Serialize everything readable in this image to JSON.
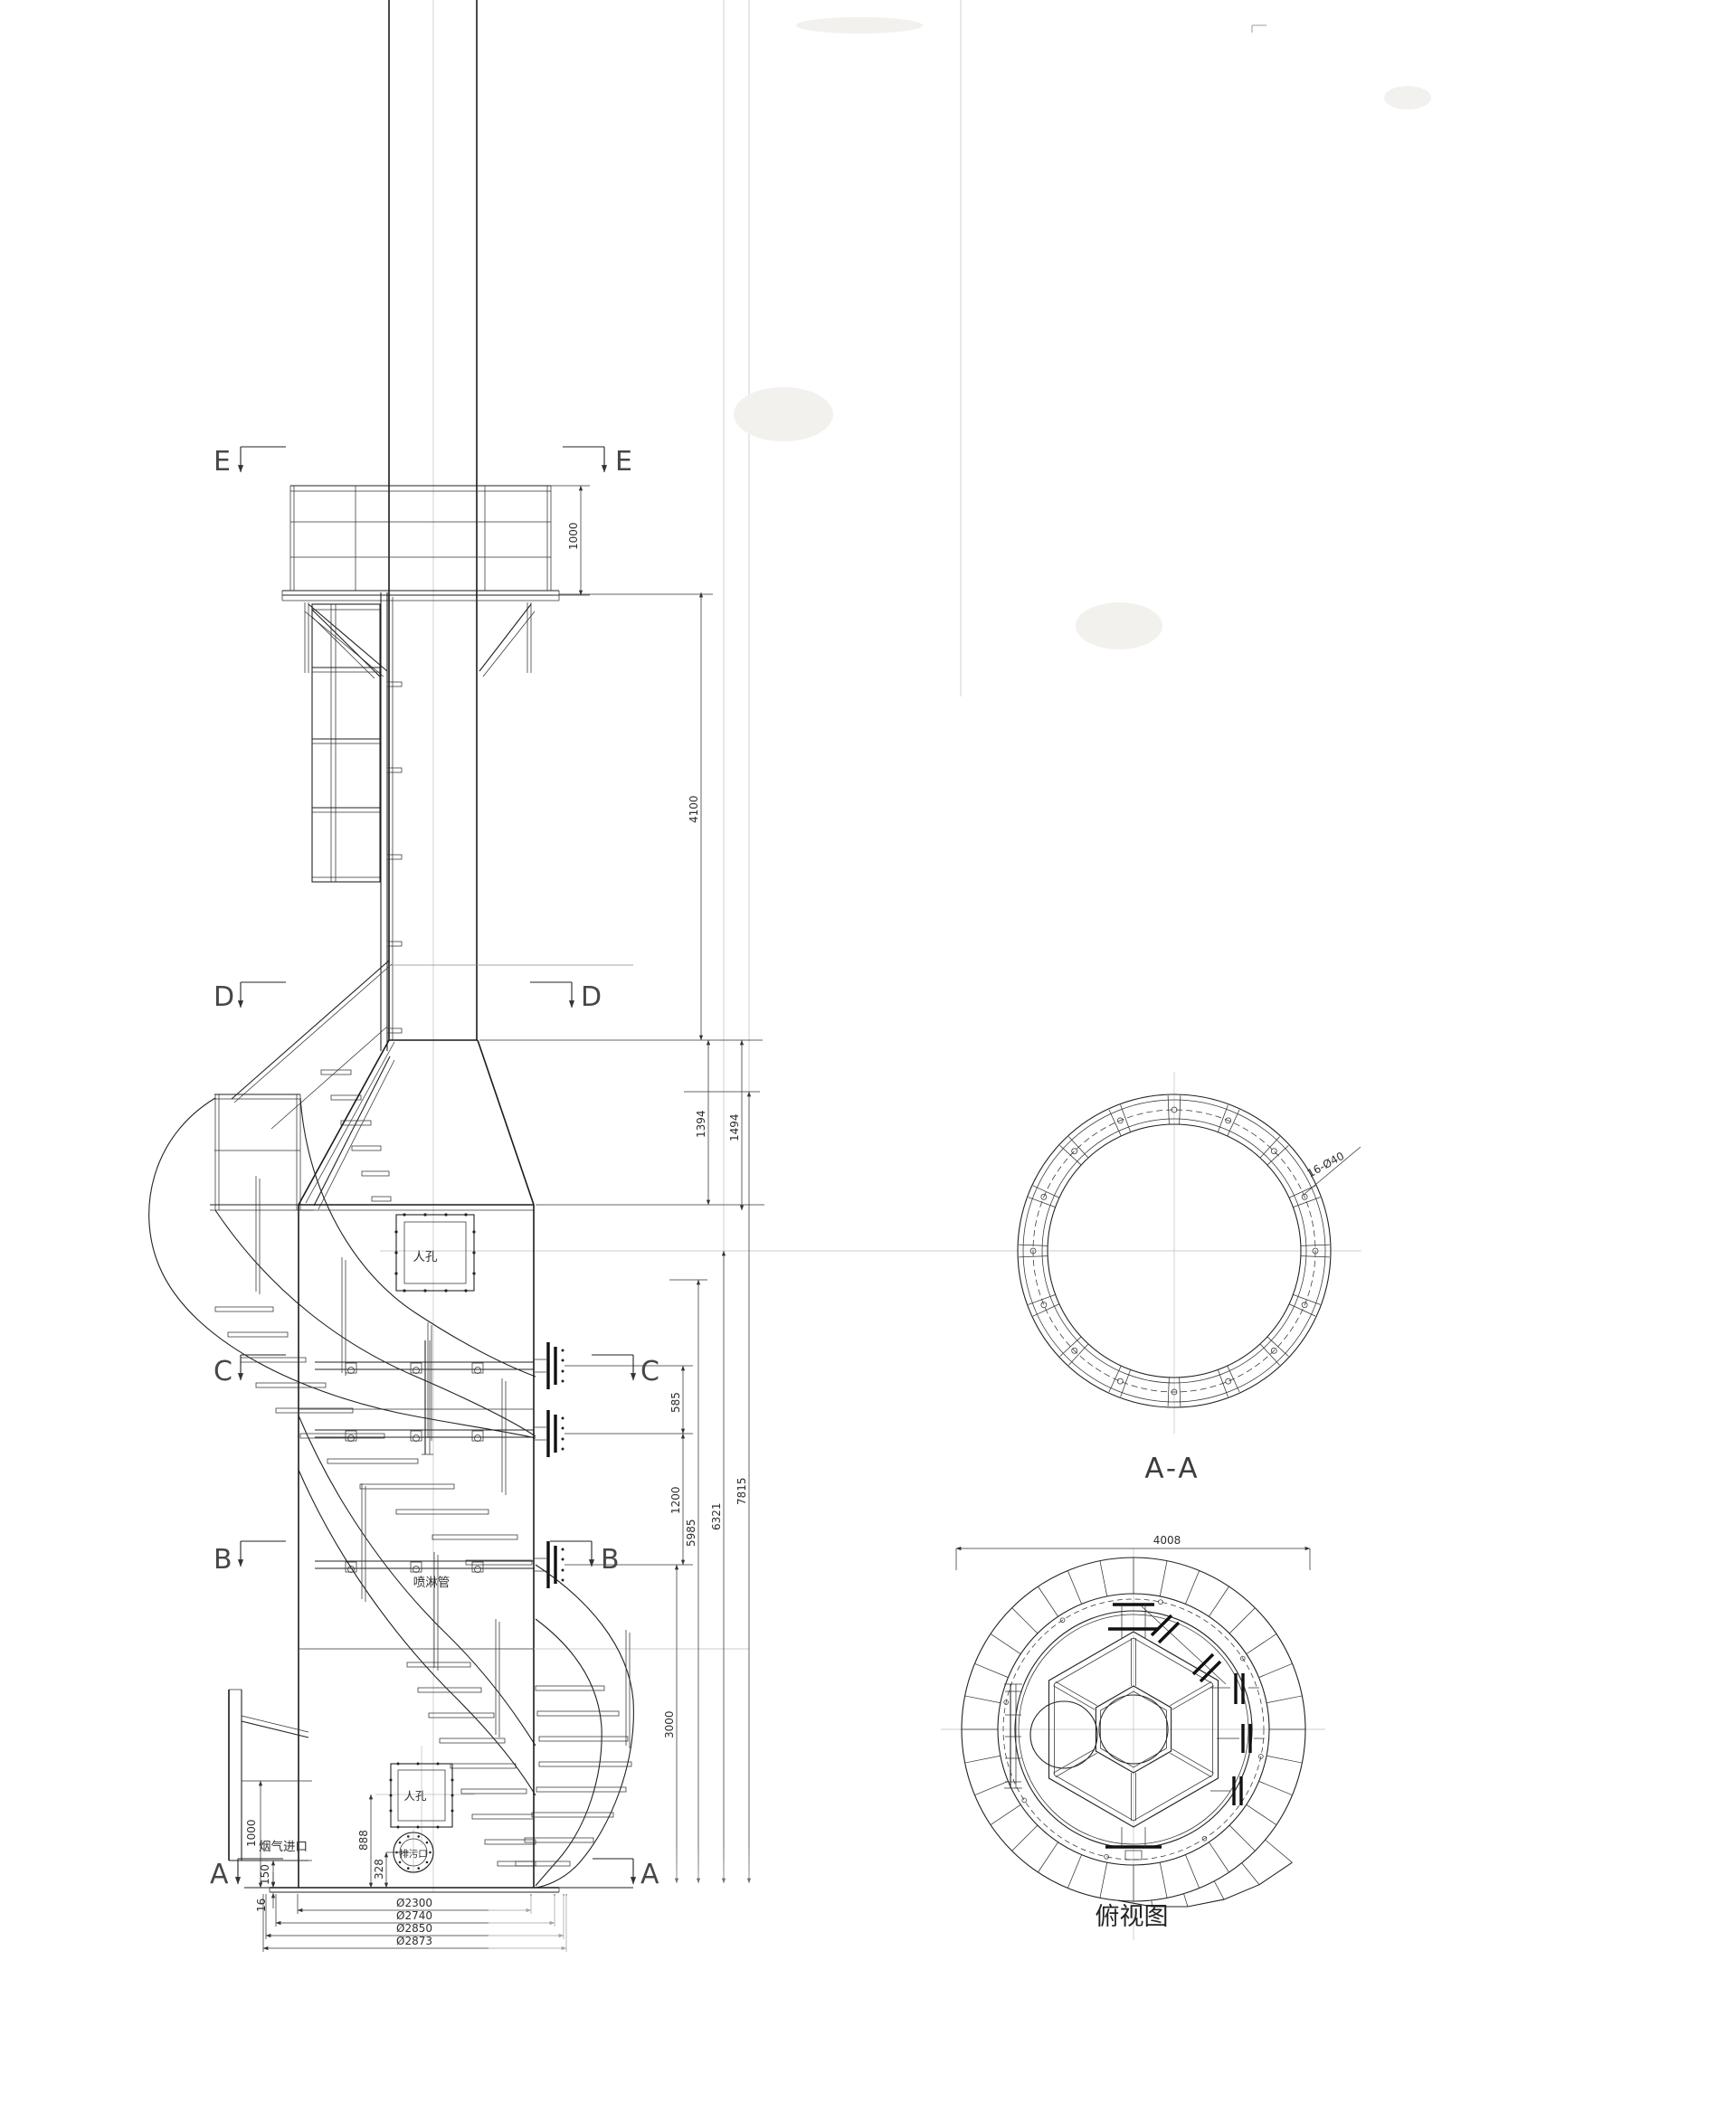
{
  "drawing": {
    "title": "俯视图",
    "colors": {
      "line": "#1a1a1a",
      "paper": "#ffffff",
      "construction": "#bdbdbd"
    },
    "section_markers": {
      "e": "E",
      "d": "D",
      "c": "C",
      "b": "B",
      "a": "A"
    },
    "labels": {
      "manhole_upper": "人孔",
      "manhole_lower": "人孔",
      "spray_pipe": "喷淋管",
      "drain": "排污口",
      "flue_inlet": "烟气进口",
      "section_aa": "A-A",
      "top_view": "俯视图"
    },
    "dims": {
      "platform_rail_height": "1000",
      "stack_height": "4100",
      "cone_height": "1394",
      "cone_total_height": "1494",
      "nozzle_gap_1": "585",
      "nozzle_gap_2": "1200",
      "shell_dim_1": "5985",
      "shell_dim_2": "6321",
      "shell_dim_3": "7815",
      "lower_section": "3000",
      "manhole_elev": "888",
      "drain_elev": "328",
      "inlet_height": "1000",
      "skirt_dim": "150",
      "plate_thk": "16",
      "dia_1": "Ø2300",
      "dia_2": "Ø2740",
      "dia_3": "Ø2850",
      "dia_4": "Ø2873",
      "plan_dia": "4008",
      "bolt_note": "16-Ø40"
    }
  }
}
